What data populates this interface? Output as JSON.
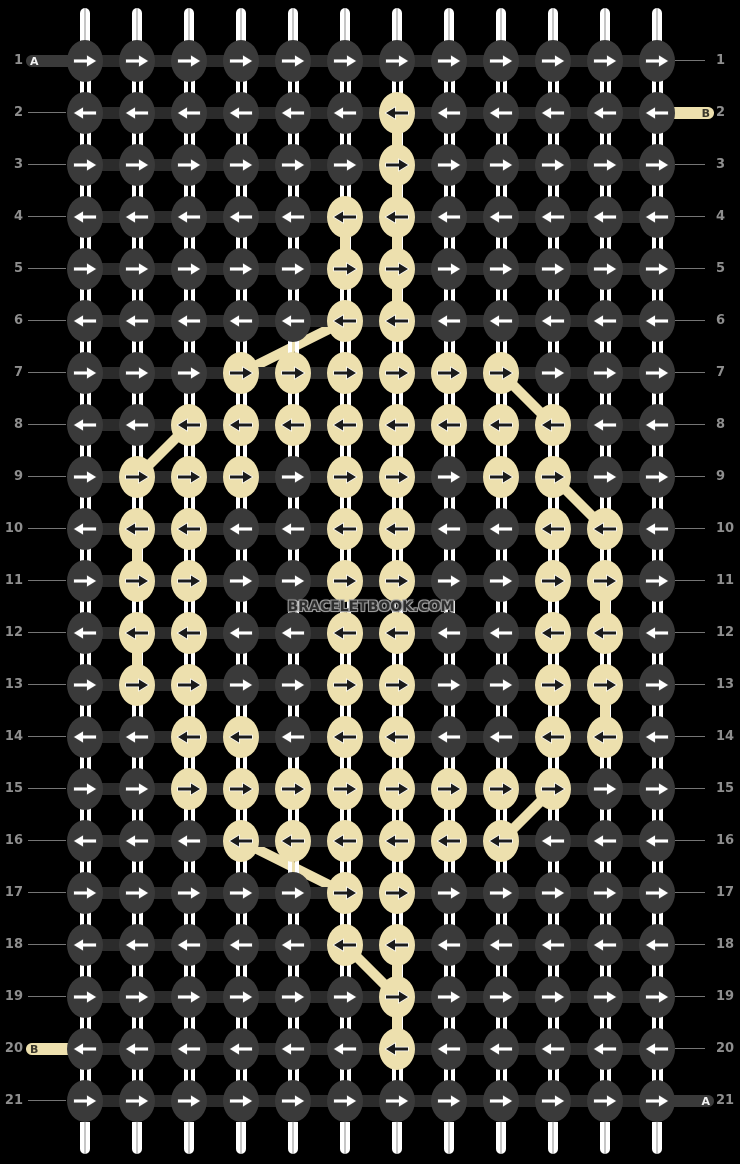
{
  "pattern_viewer": {
    "watermark": "BRACELETBOOK.COM",
    "colors": {
      "background": "#000000",
      "knot_dark": "#3A3A3A",
      "knot_beige": "#EDE0AE",
      "connector": "#2B2B2B",
      "warp_string": "#FFFFFF",
      "arrow_on_dark": "#FFFFFF",
      "arrow_on_dark_outline": "#565656",
      "arrow_on_beige": "#1B1B1B",
      "arrow_on_beige_outline": "#FFFFFF",
      "row_number": "#8E8E8E",
      "guide_line": "#757575",
      "capsule_dark": "#3A3A3A",
      "capsule_beige": "#EDE0AE",
      "capsule_letter_on_dark": "#F2F2F2",
      "capsule_letter_on_beige": "#3B382C",
      "watermark_text": "#2E2E2E"
    },
    "grid": {
      "num_rows": 21,
      "num_columns": 12,
      "knot_color_legend": {
        "d": "dark",
        "b": "beige"
      },
      "rows": [
        {
          "number": "1",
          "arrow_direction": "right",
          "knot_colors": "dddddddddddd"
        },
        {
          "number": "2",
          "arrow_direction": "left",
          "knot_colors": "ddddddbddddd"
        },
        {
          "number": "3",
          "arrow_direction": "right",
          "knot_colors": "ddddddbddddd"
        },
        {
          "number": "4",
          "arrow_direction": "left",
          "knot_colors": "dddddbbddddd"
        },
        {
          "number": "5",
          "arrow_direction": "right",
          "knot_colors": "dddddbbddddd"
        },
        {
          "number": "6",
          "arrow_direction": "left",
          "knot_colors": "dddddbbddddd"
        },
        {
          "number": "7",
          "arrow_direction": "right",
          "knot_colors": "dddbbbbbbddd"
        },
        {
          "number": "8",
          "arrow_direction": "left",
          "knot_colors": "ddbbbbbbbbdd"
        },
        {
          "number": "9",
          "arrow_direction": "right",
          "knot_colors": "dbbbdbbdbbdd"
        },
        {
          "number": "10",
          "arrow_direction": "left",
          "knot_colors": "dbbddbbddbbd"
        },
        {
          "number": "11",
          "arrow_direction": "right",
          "knot_colors": "dbbddbbddbbd"
        },
        {
          "number": "12",
          "arrow_direction": "left",
          "knot_colors": "dbbddbbddbbd"
        },
        {
          "number": "13",
          "arrow_direction": "right",
          "knot_colors": "dbbddbbddbbd"
        },
        {
          "number": "14",
          "arrow_direction": "left",
          "knot_colors": "ddbbdbbddbbd"
        },
        {
          "number": "15",
          "arrow_direction": "right",
          "knot_colors": "ddbbbbbbbbdd"
        },
        {
          "number": "16",
          "arrow_direction": "left",
          "knot_colors": "dddbbbbbbddd"
        },
        {
          "number": "17",
          "arrow_direction": "right",
          "knot_colors": "dddddbbddddd"
        },
        {
          "number": "18",
          "arrow_direction": "left",
          "knot_colors": "dddddbbddddd"
        },
        {
          "number": "19",
          "arrow_direction": "right",
          "knot_colors": "ddddddbddddd"
        },
        {
          "number": "20",
          "arrow_direction": "left",
          "knot_colors": "ddddddbddddd"
        },
        {
          "number": "21",
          "arrow_direction": "right",
          "knot_colors": "dddddddddddd"
        }
      ]
    },
    "thread_markers": [
      {
        "row": 1,
        "side": "left",
        "label": "A",
        "color": "dark"
      },
      {
        "row": 2,
        "side": "right",
        "label": "B",
        "color": "beige"
      },
      {
        "row": 20,
        "side": "left",
        "label": "B",
        "color": "beige"
      },
      {
        "row": 21,
        "side": "right",
        "label": "A",
        "color": "dark"
      }
    ],
    "weft_travel_diagonals": [
      {
        "from_row": 6,
        "from_col": 6,
        "to_row": 7,
        "to_col": 4
      },
      {
        "from_row": 7,
        "from_col": 9,
        "to_row": 8,
        "to_col": 10
      },
      {
        "from_row": 8,
        "from_col": 3,
        "to_row": 9,
        "to_col": 2
      },
      {
        "from_row": 9,
        "from_col": 10,
        "to_row": 10,
        "to_col": 11
      },
      {
        "from_row": 15,
        "from_col": 10,
        "to_row": 16,
        "to_col": 9
      },
      {
        "from_row": 16,
        "from_col": 4,
        "to_row": 17,
        "to_col": 6
      },
      {
        "from_row": 18,
        "from_col": 6,
        "to_row": 19,
        "to_col": 7
      }
    ],
    "weft_vertical_segments": [
      {
        "above_row": 2,
        "col": 7
      },
      {
        "above_row": 3,
        "col": 7
      },
      {
        "above_row": 4,
        "col": 7
      },
      {
        "above_row": 5,
        "col": 7
      },
      {
        "above_row": 4,
        "col": 6
      },
      {
        "above_row": 10,
        "col": 2
      },
      {
        "above_row": 12,
        "col": 2
      },
      {
        "above_row": 11,
        "col": 11
      },
      {
        "above_row": 13,
        "col": 11
      },
      {
        "above_row": 18,
        "col": 7
      },
      {
        "above_row": 19,
        "col": 7
      }
    ]
  }
}
